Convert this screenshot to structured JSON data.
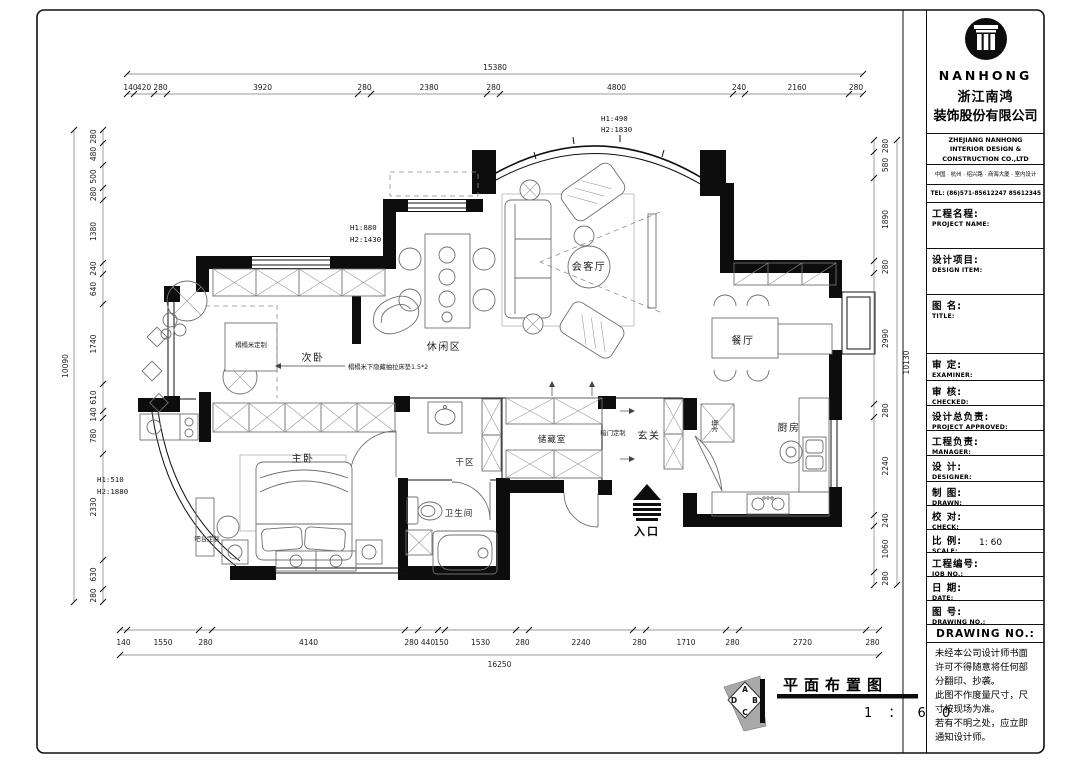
{
  "title_block": {
    "logo_text": "NANHONG",
    "company_cn_1": "浙江南鸿",
    "company_cn_2": "装饰股份有限公司",
    "company_en_1": "ZHEJIANG NANHONG",
    "company_en_2": "INTERIOR DESIGN &",
    "company_en_3": "CONSTRUCTION CO.,LTD",
    "address": "中国 · 杭州 · 绍兴路 · 商海大厦 · 室内设计",
    "tel": "TEL: (86)571-85612247  85612345",
    "scale_value": "1: 60",
    "fields": [
      {
        "cn": "工程名程:",
        "en": "PROJECT NAME:"
      },
      {
        "cn": "设计项目:",
        "en": "DESIGN ITEM:"
      },
      {
        "cn": "图  名:",
        "en": "TITLE:"
      },
      {
        "cn": "审    定:",
        "en": "EXAMINER:"
      },
      {
        "cn": "审    核:",
        "en": "CHECKED:"
      },
      {
        "cn": "设计总负责:",
        "en": "PROJECT APPROVED:"
      },
      {
        "cn": "工程负责:",
        "en": "MANAGER:"
      },
      {
        "cn": "设    计:",
        "en": "DESIGNER:"
      },
      {
        "cn": "制    图:",
        "en": "DRAWN:"
      },
      {
        "cn": "校    对:",
        "en": "CHECK:"
      },
      {
        "cn": "比    例:",
        "en": "SCALE:"
      },
      {
        "cn": "工程编号:",
        "en": "JOB  NO.:"
      },
      {
        "cn": "日    期:",
        "en": "DATE:"
      },
      {
        "cn": "图    号:",
        "en": "DRAWING NO.:"
      }
    ],
    "drawing_no_header": "DRAWING NO.:",
    "notes": [
      "未经本公司设计师书面",
      "许可不得随意将任何部",
      "分翻印、抄袭。",
      "此图不作度量尺寸，尺",
      "寸按现场为准。",
      "若有不明之处，应立即",
      "通知设计师。"
    ]
  },
  "footer": {
    "title": "平面布置图",
    "scale": "1 ： 6 0",
    "marker": [
      "A",
      "B",
      "C",
      "D"
    ]
  },
  "plan": {
    "rooms": {
      "living": "会客厅",
      "dining": "餐厅",
      "leisure": "休闲区",
      "bedroom2": "次卧",
      "master": "主卧",
      "dry_area": "干区",
      "bathroom": "卫生间",
      "storage": "储藏室",
      "foyer": "玄关",
      "kitchen": "厨房"
    },
    "labels": {
      "entrance": "入口",
      "fridge": "冰箱",
      "tatami": "榻榻米定制",
      "tatami_note": "榻榻米下隐藏抽拉床垫1.5*2",
      "hidden_door": "暗门定制",
      "bar": "吧台定制"
    },
    "height_notes": {
      "bay": {
        "l1": "H1:490",
        "l2": "H2:1830"
      },
      "leisure": {
        "l1": "H1:880",
        "l2": "H2:1430"
      },
      "master": {
        "l1": "H1:510",
        "l2": "H2:1880"
      }
    }
  },
  "dims": {
    "top": {
      "overall": "15380",
      "segments": [
        "140",
        "420",
        "280",
        "3920",
        "280",
        "2380",
        "280",
        "4800",
        "240",
        "2160",
        "280"
      ]
    },
    "bottom": {
      "overall": "16250",
      "segments": [
        "140",
        "1550",
        "280",
        "4140",
        "280",
        "440",
        "150",
        "1530",
        "280",
        "2240",
        "280",
        "1710",
        "280",
        "2720",
        "280"
      ]
    },
    "left": {
      "overall": "10090",
      "segments": [
        "280",
        "480",
        "500",
        "280",
        "1380",
        "240",
        "640",
        "1740",
        "610",
        "140",
        "780",
        "2330",
        "630",
        "280"
      ]
    },
    "right": {
      "overall": "10130",
      "segments": [
        "280",
        "580",
        "1890",
        "280",
        "2990",
        "280",
        "2240",
        "240",
        "1060",
        "280"
      ]
    }
  }
}
